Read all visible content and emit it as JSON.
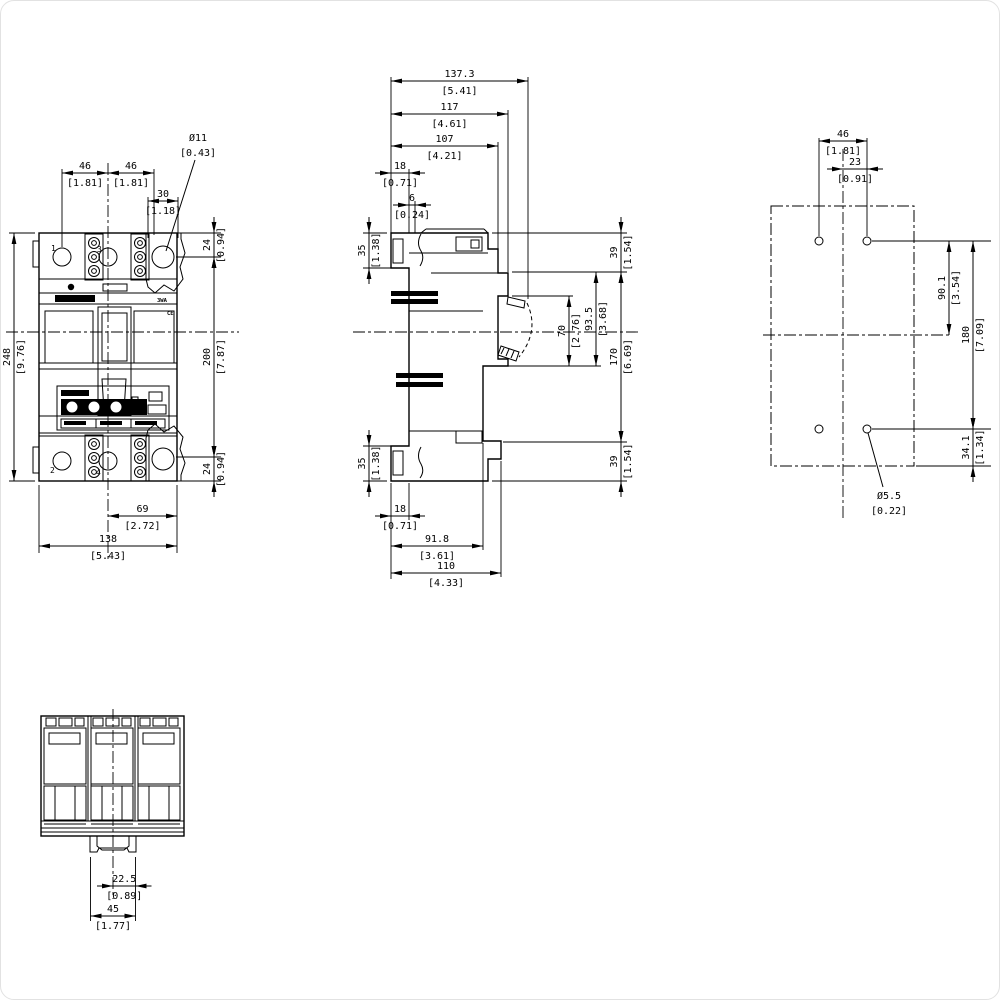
{
  "drawing": {
    "colors": {
      "line": "#000000",
      "background": "#ffffff"
    },
    "labels": {
      "pole1": "1",
      "pole3": "3",
      "pole2": "2",
      "pole4": "4",
      "brand": "3WA",
      "ce_mark": "CE"
    },
    "dims": [
      {
        "view": "front",
        "t": "h",
        "mm": "46",
        "in": "[1.81]",
        "x1": 61,
        "x2": 107,
        "y": 172,
        "a": "in"
      },
      {
        "view": "front",
        "t": "h",
        "mm": "46",
        "in": "[1.81]",
        "x1": 107,
        "x2": 153,
        "y": 172,
        "a": "in"
      },
      {
        "view": "front",
        "t": "h",
        "mm": "30",
        "in": "[1.18]",
        "x1": 147,
        "x2": 177,
        "y": 200,
        "a": "in"
      },
      {
        "view": "front",
        "t": "l",
        "mm": "Ø11",
        "in": "[0.43]",
        "x1": 194,
        "y1": 159,
        "x2": 165,
        "y2": 250,
        "tx": 197,
        "ty": 140
      },
      {
        "view": "front",
        "t": "v",
        "mm": "24",
        "in": "[0.94]",
        "x": 213,
        "y1": 232,
        "y2": 256,
        "a": "out"
      },
      {
        "view": "front",
        "t": "v",
        "mm": "200",
        "in": "[7.87]",
        "x": 213,
        "y1": 256,
        "y2": 456,
        "a": "in"
      },
      {
        "view": "front",
        "t": "v",
        "mm": "24",
        "in": "[0.94]",
        "x": 213,
        "y1": 456,
        "y2": 480,
        "a": "out"
      },
      {
        "view": "front",
        "t": "v",
        "mm": "248",
        "in": "[9.76]",
        "x": 13,
        "y1": 232,
        "y2": 480,
        "a": "in"
      },
      {
        "view": "front",
        "t": "h",
        "mm": "69",
        "in": "[2.72]",
        "x1": 107,
        "x2": 176,
        "y": 515,
        "a": "in"
      },
      {
        "view": "front",
        "t": "h",
        "mm": "138",
        "in": "[5.43]",
        "x1": 38,
        "x2": 176,
        "y": 545,
        "a": "in"
      },
      {
        "view": "side",
        "t": "h",
        "mm": "137.3",
        "in": "[5.41]",
        "x1": 390,
        "x2": 527,
        "y": 80,
        "a": "in"
      },
      {
        "view": "side",
        "t": "h",
        "mm": "117",
        "in": "[4.61]",
        "x1": 390,
        "x2": 507,
        "y": 113,
        "a": "in"
      },
      {
        "view": "side",
        "t": "h",
        "mm": "107",
        "in": "[4.21]",
        "x1": 390,
        "x2": 497,
        "y": 145,
        "a": "in"
      },
      {
        "view": "side",
        "t": "h",
        "mm": "18",
        "in": "[0.71]",
        "x1": 390,
        "x2": 408,
        "y": 172,
        "a": "out"
      },
      {
        "view": "side",
        "t": "h",
        "mm": "6",
        "in": "[0.24]",
        "x1": 408,
        "x2": 414,
        "y": 204,
        "a": "out"
      },
      {
        "view": "side",
        "t": "v",
        "mm": "35",
        "in": "[1.38]",
        "x": 368,
        "y1": 232,
        "y2": 267,
        "a": "out"
      },
      {
        "view": "side",
        "t": "v",
        "mm": "35",
        "in": "[1.38]",
        "x": 368,
        "y1": 445,
        "y2": 480,
        "a": "out"
      },
      {
        "view": "side",
        "t": "v",
        "mm": "39",
        "in": "[1.54]",
        "x": 620,
        "y1": 232,
        "y2": 271,
        "a": "out"
      },
      {
        "view": "side",
        "t": "v",
        "mm": "170",
        "in": "[6.69]",
        "x": 620,
        "y1": 271,
        "y2": 441,
        "a": "in"
      },
      {
        "view": "side",
        "t": "v",
        "mm": "39",
        "in": "[1.54]",
        "x": 620,
        "y1": 441,
        "y2": 480,
        "a": "out"
      },
      {
        "view": "side",
        "t": "v",
        "mm": "70",
        "in": "[2.76]",
        "x": 568,
        "y1": 295,
        "y2": 365,
        "a": "in"
      },
      {
        "view": "side",
        "t": "v",
        "mm": "93.5",
        "in": "[3.68]",
        "x": 595,
        "y1": 271,
        "y2": 365,
        "a": "in"
      },
      {
        "view": "side",
        "t": "h",
        "mm": "18",
        "in": "[0.71]",
        "x1": 390,
        "x2": 408,
        "y": 515,
        "a": "out"
      },
      {
        "view": "side",
        "t": "h",
        "mm": "91.8",
        "in": "[3.61]",
        "x1": 390,
        "x2": 482,
        "y": 545,
        "a": "in"
      },
      {
        "view": "side",
        "t": "h",
        "mm": "110",
        "in": "[4.33]",
        "x1": 390,
        "x2": 500,
        "y": 572,
        "a": "in"
      },
      {
        "view": "drill",
        "t": "h",
        "mm": "46",
        "in": "[1.81]",
        "x1": 818,
        "x2": 866,
        "y": 140,
        "a": "in"
      },
      {
        "view": "drill",
        "t": "h",
        "mm": "23",
        "in": "[0.91]",
        "x1": 842,
        "x2": 866,
        "y": 168,
        "a": "out"
      },
      {
        "view": "drill",
        "t": "v",
        "mm": "90.1",
        "in": "[3.54]",
        "x": 948,
        "y1": 240,
        "y2": 334,
        "a": "in"
      },
      {
        "view": "drill",
        "t": "v",
        "mm": "180",
        "in": "[7.09]",
        "x": 972,
        "y1": 240,
        "y2": 428,
        "a": "in"
      },
      {
        "view": "drill",
        "t": "v",
        "mm": "34.1",
        "in": "[1.34]",
        "x": 972,
        "y1": 428,
        "y2": 465,
        "a": "out"
      },
      {
        "view": "drill",
        "t": "l",
        "mm": "Ø5.5",
        "in": "[0.22]",
        "x1": 882,
        "y1": 486,
        "x2": 867,
        "y2": 432,
        "tx": 888,
        "ty": 498
      },
      {
        "view": "bottom",
        "t": "h",
        "mm": "22.5",
        "in": "[0.89]",
        "x1": 112,
        "x2": 134.5,
        "y": 885,
        "a": "out"
      },
      {
        "view": "bottom",
        "t": "h",
        "mm": "45",
        "in": "[1.77]",
        "x1": 89.5,
        "x2": 134.5,
        "y": 915,
        "a": "in"
      }
    ]
  }
}
